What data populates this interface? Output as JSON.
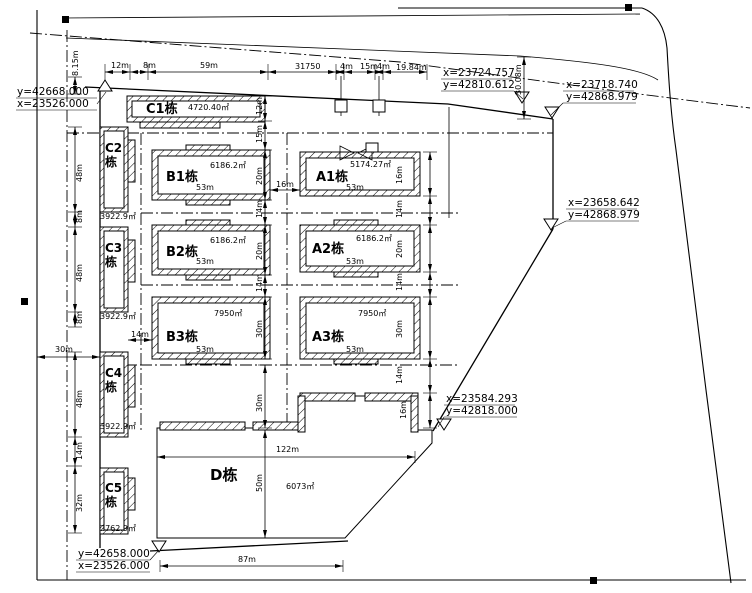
{
  "drawing_type": "residential site plan (CAD)",
  "buildings": {
    "C1": {
      "name": "C1栋",
      "area": "4720.40㎡"
    },
    "C2": {
      "name": "C2栋",
      "area": "3922.9㎡"
    },
    "C3": {
      "name": "C3栋",
      "area": "3922.9㎡"
    },
    "C4": {
      "name": "C4栋",
      "area": "3922.9㎡"
    },
    "C5": {
      "name": "C5栋",
      "area": "2762.9㎡"
    },
    "B1": {
      "name": "B1栋",
      "area": "6186.2㎡"
    },
    "B2": {
      "name": "B2栋",
      "area": "6186.2㎡"
    },
    "B3": {
      "name": "B3栋",
      "area": "7950㎡"
    },
    "A1": {
      "name": "A1栋",
      "area": "5174.27㎡"
    },
    "A2": {
      "name": "A2栋",
      "area": "6186.2㎡"
    },
    "A3": {
      "name": "A3栋",
      "area": "7950㎡"
    },
    "D": {
      "name": "D栋",
      "area": "6073㎡"
    }
  },
  "survey_points": {
    "nw": {
      "line1": "y=42668.000",
      "line2": "x=23526.000"
    },
    "gate": {
      "line1": "x=23724.757",
      "line2": "y=42810.612"
    },
    "ne": {
      "line1": "x=23718.740",
      "line2": "y=42868.979"
    },
    "e": {
      "line1": "x=23658.642",
      "line2": "y=42868.979"
    },
    "se": {
      "line1": "x=23584.293",
      "line2": "y=42818.000"
    },
    "sw": {
      "line1": "y=42658.000",
      "line2": "x=23526.000"
    }
  },
  "dims": {
    "left_top_vertical": "8.15m",
    "top_chain": [
      "12m",
      "8m",
      "59m",
      "31750",
      "4m",
      "15m",
      "4m",
      "19.84m"
    ],
    "left_chain": [
      "48m",
      "8m",
      "48m",
      "8m",
      "48m",
      "14m",
      "32m"
    ],
    "left_offset": "30m",
    "mid_chain": [
      "12m",
      "15m",
      "20m",
      "14m",
      "20m",
      "14m",
      "30m"
    ],
    "right_chain": [
      "16m",
      "14m",
      "20m",
      "14m",
      "30m",
      "14m",
      "16m"
    ],
    "gap_c_b3": "14m",
    "gap_b1_a1": "16m",
    "road_width": "30.08m",
    "d_top_offset": "30m",
    "d_height": "50m",
    "d_width": "122m",
    "d_bottom": "87m",
    "building_width": "53m"
  },
  "colors": {
    "line": "#000000",
    "background": "#ffffff"
  }
}
